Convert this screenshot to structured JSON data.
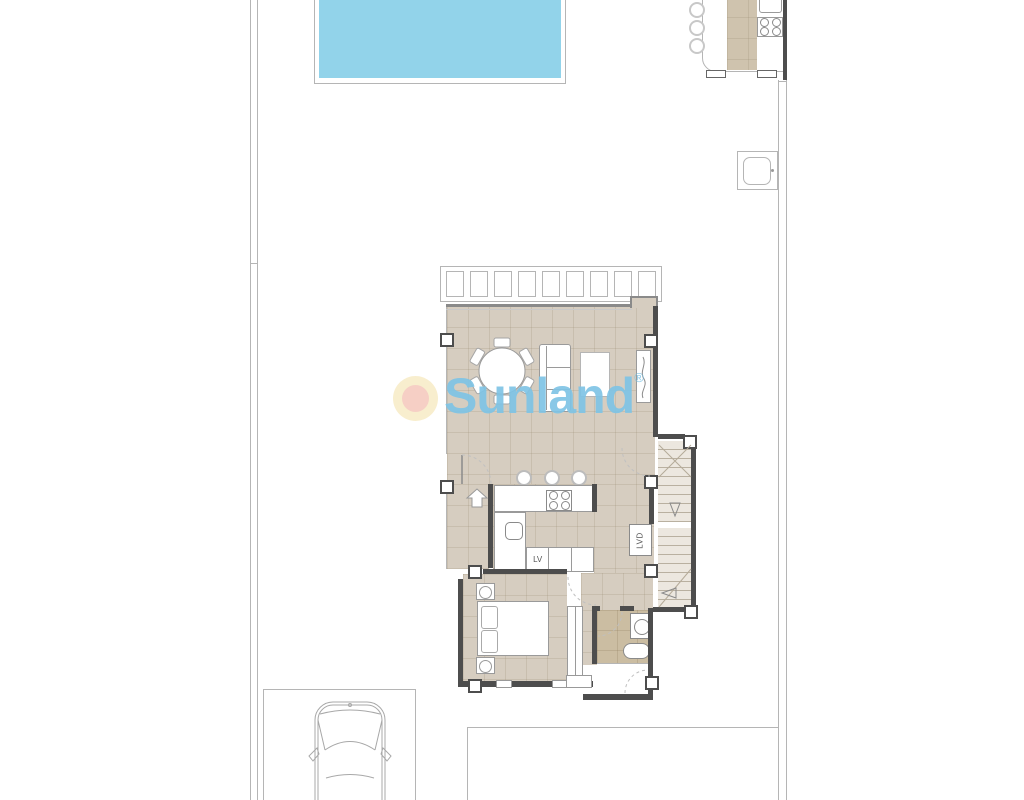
{
  "watermark": {
    "brand": "Sunland",
    "registered": "®"
  },
  "labels": {
    "dishwasher": "LV",
    "laundry": "LVD"
  },
  "colors": {
    "pool": "#92d3ea",
    "floor": "#d6cdc0",
    "floor_dark": "#cbbda2",
    "stair_floor": "#ece7df",
    "outdoor_strip": "#cfc3ae",
    "wall": "#4d4d4d",
    "line_light": "#b5b5b5",
    "line_mid": "#8a8a8a",
    "furn": "#9a9a9a",
    "logo_blue": "#7fc4e5",
    "sun_outer": "#f8edca",
    "sun_inner": "#f6cbc1"
  }
}
